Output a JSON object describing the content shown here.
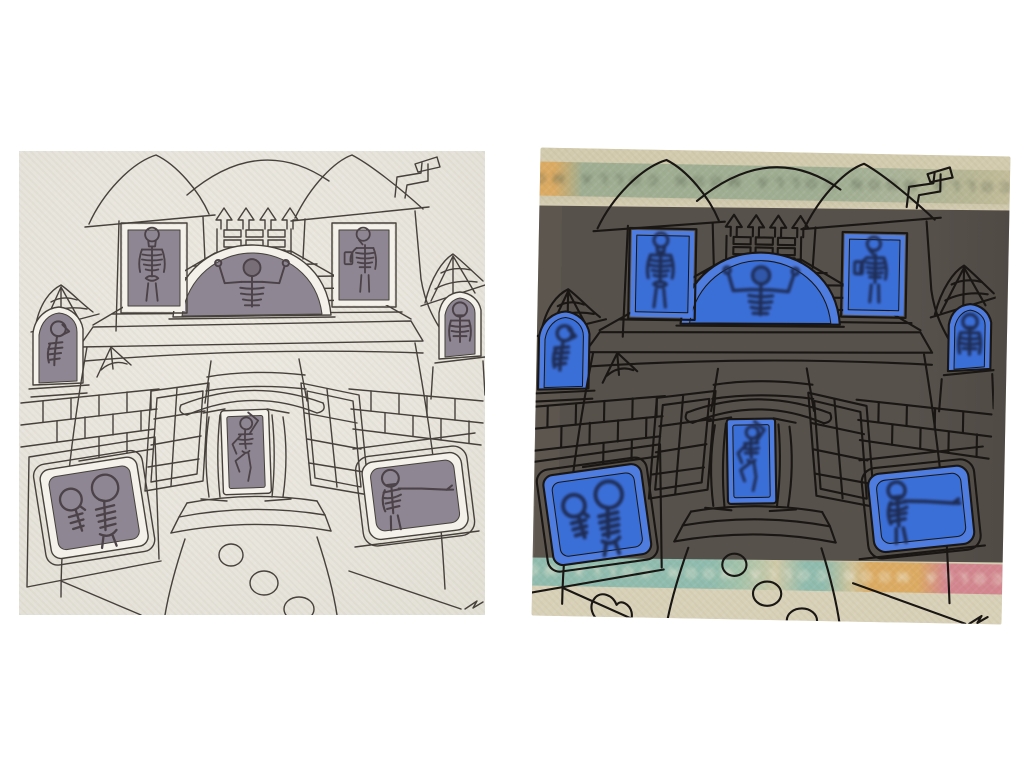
{
  "page": {
    "background_color": "#ffffff",
    "description": "Two photographs of the same hand-drawn haunted house, side by side: left lit normally on cream paper with grey photo windows, right backlit on dark paper with glowing blue windows and washi-tape strips"
  },
  "scene": {
    "subject": "haunted house ink drawing with skeleton cut-outs in every window",
    "windows": [
      {
        "id": "upper-left-window",
        "skeleton": "standing skeleton"
      },
      {
        "id": "upper-right-window",
        "skeleton": "skeleton looking at a phone"
      },
      {
        "id": "dome-window",
        "skeleton": "skeleton flexing both arms"
      },
      {
        "id": "side-left-window",
        "skeleton": "skeleton in profile looking up"
      },
      {
        "id": "side-right-window",
        "skeleton": "skeleton facing forward"
      },
      {
        "id": "front-door",
        "skeleton": "dancing skeleton"
      },
      {
        "id": "lower-left-window",
        "skeleton": "two crouching skeletons"
      },
      {
        "id": "lower-right-window",
        "skeleton": "skeleton with arm outstretched"
      }
    ]
  },
  "left_photo": {
    "label": "drawing in normal light",
    "css_vars": {
      "--line": "#46413b",
      "--lw": "1.4",
      "--window": "#8e8692",
      "--edge": "#f3f1ea",
      "--bone": "#4c4349",
      "--bw": "1.5",
      "--skelblur": "none",
      "--extra": "transparent"
    }
  },
  "right_photo": {
    "label": "drawing backlit on dark paper",
    "css_vars": {
      "--backing": "#d5cdb2",
      "--dark": "#57514c",
      "--line": "#191613",
      "--lw": "2.1",
      "--window": "#3b6fd8",
      "--edge": "#4f7cdf",
      "--bone": "#1e2c54",
      "--bw": "2.5",
      "--skelblur": "blur(1.4px)",
      "--extra": "#191613",
      "--tape-green": "#9fae92",
      "--tape-orange": "#dcab62",
      "--tape-teal": "#8fbcae",
      "--tape-pink": "#d3868f",
      "--wm-top-color": "#55604f",
      "--wm-bottom-color": "#efe9d8"
    },
    "strip_top": {
      "watermark_text": "COLLA MOON   COLLA MOON   COLLA MOON"
    },
    "strip_bottom": {
      "watermark_text": "COLLA MOON   COLLA MOON   COLLA MOON   COLLA MOON"
    }
  }
}
